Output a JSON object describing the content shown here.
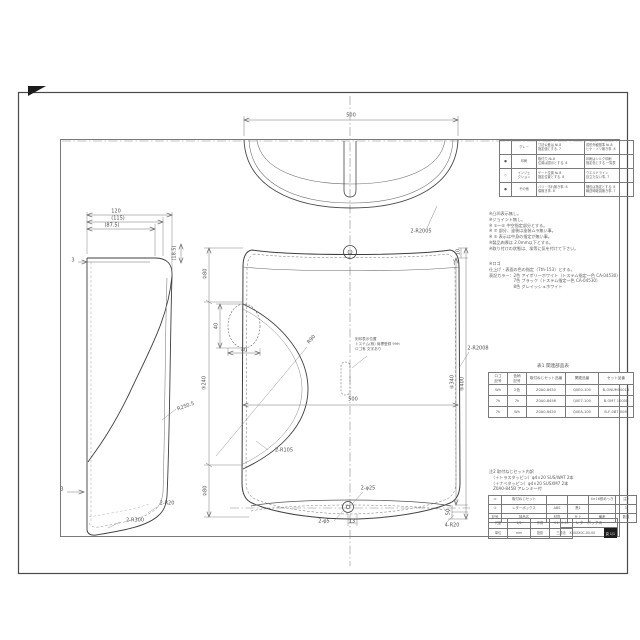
{
  "drawing": {
    "dim_labels": [
      {
        "text": "500",
        "x": 351,
        "y": 116,
        "rot": 0
      },
      {
        "text": "2-R2005",
        "x": 421,
        "y": 232,
        "rot": 0
      },
      {
        "text": "120",
        "x": 116,
        "y": 212,
        "rot": 0
      },
      {
        "text": "(115)",
        "x": 118,
        "y": 219,
        "rot": 0
      },
      {
        "text": "(87.5)",
        "x": 112,
        "y": 226,
        "rot": 0
      },
      {
        "text": "(18.5)",
        "x": 175,
        "y": 253,
        "rot": -90
      },
      {
        "text": "3",
        "x": 73,
        "y": 261,
        "rot": 0
      },
      {
        "text": "R250.5",
        "x": 186,
        "y": 407,
        "rot": -20
      },
      {
        "text": "2-R20",
        "x": 167,
        "y": 504,
        "rot": 0
      },
      {
        "text": "2-R300",
        "x": 135,
        "y": 521,
        "rot": 0
      },
      {
        "text": "3",
        "x": 62,
        "y": 490,
        "rot": 0
      },
      {
        "text": "②80",
        "x": 206,
        "y": 274,
        "rot": -90
      },
      {
        "text": "③240",
        "x": 205,
        "y": 383,
        "rot": -90
      },
      {
        "text": "②80",
        "x": 206,
        "y": 491,
        "rot": -90
      },
      {
        "text": "40",
        "x": 217,
        "y": 326,
        "rot": -90
      },
      {
        "text": "40",
        "x": 244,
        "y": 351,
        "rot": 0
      },
      {
        "text": "R90",
        "x": 312,
        "y": 340,
        "rot": -48
      },
      {
        "text": "2-R105",
        "x": 284,
        "y": 451,
        "rot": 0
      },
      {
        "text": "500",
        "x": 353,
        "y": 400,
        "rot": 0
      },
      {
        "text": "10",
        "x": 459,
        "y": 252,
        "rot": -90
      },
      {
        "text": "④340",
        "x": 453,
        "y": 382,
        "rot": -90
      },
      {
        "text": "⑤400",
        "x": 463,
        "y": 384,
        "rot": -90
      },
      {
        "text": "50",
        "x": 449,
        "y": 512,
        "rot": -90
      },
      {
        "text": "4-R20",
        "x": 452,
        "y": 526,
        "rot": 0
      },
      {
        "text": "2-R2008",
        "x": 478,
        "y": 349,
        "rot": 0
      },
      {
        "text": "2-φ25",
        "x": 368,
        "y": 489,
        "rot": 0
      },
      {
        "text": "2-φ5",
        "x": 324,
        "y": 522,
        "rot": 0
      },
      {
        "text": "13",
        "x": 352,
        "y": 522,
        "rot": 0
      }
    ],
    "note_on_part": {
      "lines": [
        "刻印表示位置",
        "トステム(株) 商標登録 99H",
        "ロゴ有 文字あり"
      ]
    }
  },
  "spec_table": {
    "rows": [
      [
        "",
        "グレー",
        "寸法公差は №.8\n指定値とする. 7",
        "成形外観基準 №.8\nヒケ・ソリ無き事. 8"
      ],
      [
        "●",
        "印刷",
        "取付穴 №.8\n位置は図示とする. 8",
        "印刷はシルク印刷\n指定色とする 一覧表"
      ],
      [
        "◇",
        "インジェ\nクション",
        "ゲート位置 №.8\n指定位置とする. 8",
        "ウエルドライン\n目立たない事. 7"
      ],
      [
        "●",
        "その他",
        "バリ・汚れ無き事. 8\n傷無き事. 8",
        "梱包は指定とする. 8\n輸送時破損無き事. 7"
      ]
    ]
  },
  "general_notes": {
    "lines": [
      "※凸凹表示無し。",
      "※ジョイント無し。",
      "※ ①～⑤ 中空指定部分とする。",
      "※ ⑦ 部分、塗装は塗装ムラ無い事。",
      "※ ⑤ 表示は中身の指定が無い事。",
      "※製品肉厚は 2.0mm以下とする。",
      "※取り付けの状態は、埃等に気を付けて下さい。"
    ]
  },
  "color_notes": {
    "lines": [
      "※ロゴ",
      "仕上げ・表面の色の指定（7th-153）とする。",
      "表記カラー：2色 アイボリーホワイト（トステム指定一色 CA-04530）",
      "　　　　　　7色 ブラック（トステム指定一色 CA-04530）",
      "　　　　　　8色 グレイッシュホワイト"
    ]
  },
  "table1": {
    "title": "表1  関連部品表",
    "rows": [
      [
        "ロゴ\n記号",
        "色柄\n記号",
        "取付ねじセット品番",
        "関連品番",
        "セット品番"
      ],
      [
        "Wh",
        "2色",
        "Z0A0-8450",
        "Q0E0-100",
        "B-ONUM1001B"
      ],
      [
        "7h",
        "7h",
        "Z0A0-8456",
        "Q0E7-100",
        "B-OM7 1000B"
      ],
      [
        "7h",
        "Wh",
        "Z0A0-8450",
        "Q0EA-100",
        "B-F-0B7-00M"
      ]
    ]
  },
  "note2": {
    "lines": [
      "注2 取付ねじセット内訳",
      "　（＋トラスタッピン）φ4×20 SUS/WAT 2本",
      "　（＋ナベタッピン）φ4×20 SUSXM7 2本",
      "　Z0A0-845B アレンキー付"
    ]
  },
  "title_block": {
    "parts_rows": [
      [
        "②",
        "取付ねじセット",
        "",
        "",
        "4×16鉄めっき",
        "注2"
      ],
      [
        "①",
        "レターボックス",
        "ABS",
        "黒1",
        "",
        "1"
      ],
      [
        "記号",
        "部品名",
        "材質",
        "仕上",
        "備考",
        "数量"
      ]
    ],
    "info_rows": [
      [
        "尺度",
        "1/2",
        "作成",
        "'01.10.15"
      ],
      [
        "単位",
        "mm",
        "投影",
        "三角法"
      ]
    ],
    "name": "レターボックス",
    "number": "XXXXX0C-00-00",
    "page": "頁 1/1"
  }
}
